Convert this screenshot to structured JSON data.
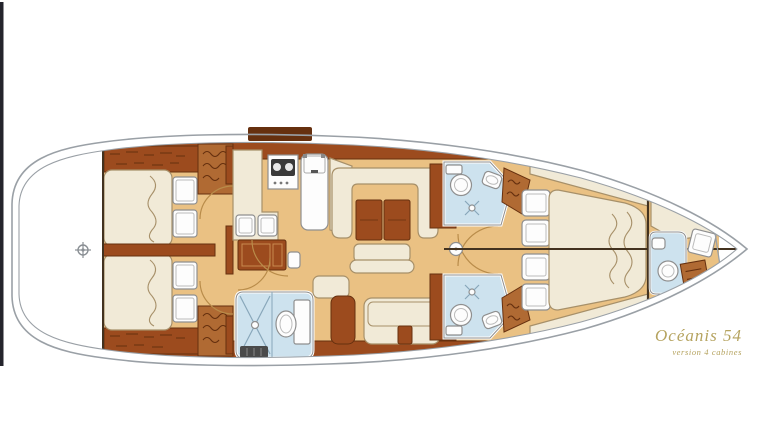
{
  "branding": {
    "model_name": "Océanis 54",
    "version_label": "version 4 cabines"
  },
  "diagram": {
    "type": "yacht-interior-floor-plan",
    "orientation": "bow-right"
  },
  "colors": {
    "floor_tan": "#eac183",
    "wood_brown": "#9c4b1e",
    "wood_mid": "#b06a33",
    "wood_dark": "#66300f",
    "upholstery_cream": "#f1ead7",
    "cream_stroke": "#a79069",
    "bathroom_blue": "#cde2ee",
    "blue_stroke": "#88a7ba",
    "fixture_white": "#fdfdfd",
    "fixture_stroke": "#8f8f8f",
    "hull_gray": "#9aa0a6",
    "line_dark": "#43321f",
    "title_gold": "#b5a35f",
    "edge_bar": "#24242c",
    "background": "#ffffff"
  }
}
